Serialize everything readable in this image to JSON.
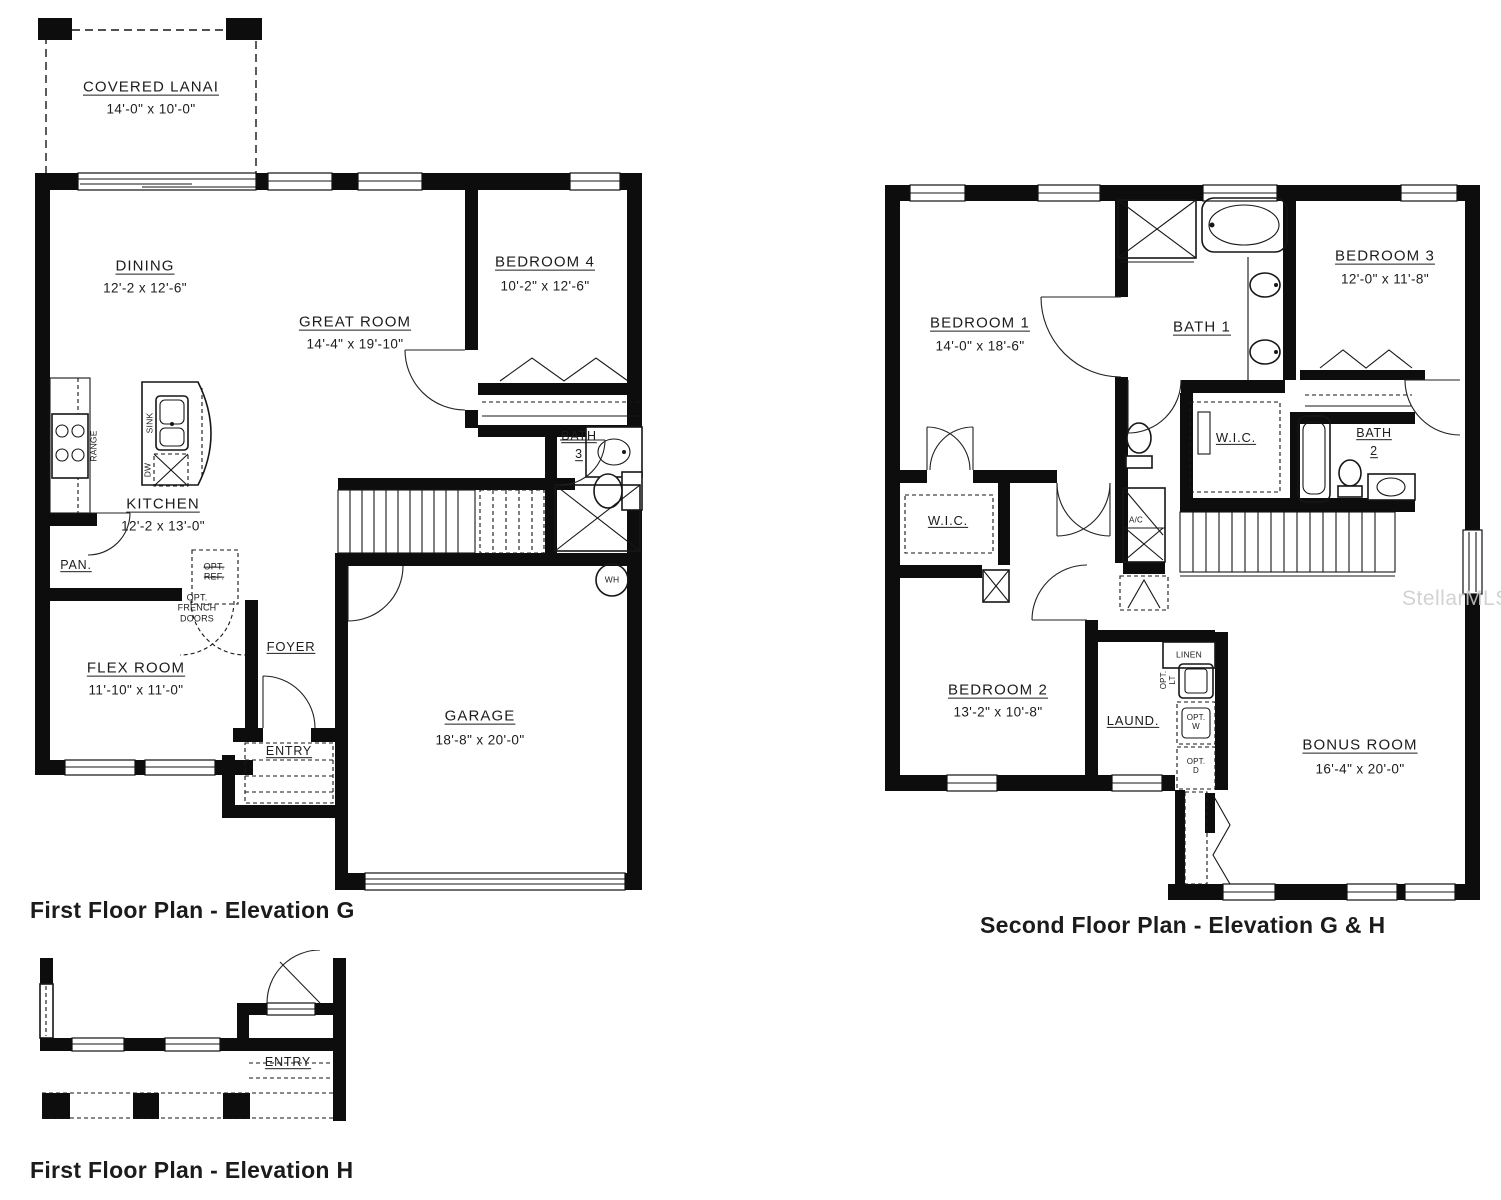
{
  "watermark": "StellarMLS",
  "plans": {
    "first_floor_g": {
      "caption": "First Floor Plan - Elevation G",
      "labels": {
        "covered_lanai": {
          "name": "COVERED LANAI",
          "dims": "14'-0\" x 10'-0\""
        },
        "dining": {
          "name": "DINING",
          "dims": "12'-2 x 12'-6\""
        },
        "great_room": {
          "name": "GREAT ROOM",
          "dims": "14'-4\" x 19'-10\""
        },
        "bedroom4": {
          "name": "BEDROOM 4",
          "dims": "10'-2\" x 12'-6\""
        },
        "kitchen": {
          "name": "KITCHEN",
          "dims": "12'-2 x 13'-0\""
        },
        "bath3": {
          "line1": "BATH",
          "line2": "3"
        },
        "pantry": "PAN.",
        "opt_ref": "OPT.\nREF.",
        "opt_french_doors": "OPT.\nFRENCH\nDOORS",
        "foyer": "FOYER",
        "flex_room": {
          "name": "FLEX ROOM",
          "dims": "11'-10\" x 11'-0\""
        },
        "entry": "ENTRY",
        "garage": {
          "name": "GARAGE",
          "dims": "18'-8\" x 20'-0\""
        },
        "range": "RANGE",
        "sink": "SINK",
        "dw": "DW",
        "wh": "WH"
      }
    },
    "second_floor_gh": {
      "caption": "Second Floor Plan - Elevation G & H",
      "labels": {
        "bedroom1": {
          "name": "BEDROOM 1",
          "dims": "14'-0\" x 18'-6\""
        },
        "bath1": "BATH 1",
        "bedroom3": {
          "name": "BEDROOM 3",
          "dims": "12'-0\" x 11'-8\""
        },
        "wic_master": "W.I.C.",
        "bath2": {
          "line1": "BATH",
          "line2": "2"
        },
        "wic2": "W.I.C.",
        "ac": "A/C",
        "bedroom2": {
          "name": "BEDROOM 2",
          "dims": "13'-2\" x 10'-8\""
        },
        "linen": "LINEN",
        "laundry": "LAUND.",
        "opt_lt": "OPT.\nLT",
        "opt_w": "OPT.\nW",
        "opt_d": "OPT.\nD",
        "bonus_room": {
          "name": "BONUS ROOM",
          "dims": "16'-4\" x 20'-0\""
        }
      }
    },
    "first_floor_h": {
      "caption": "First Floor Plan - Elevation H",
      "labels": {
        "entry": "ENTRY"
      }
    }
  }
}
